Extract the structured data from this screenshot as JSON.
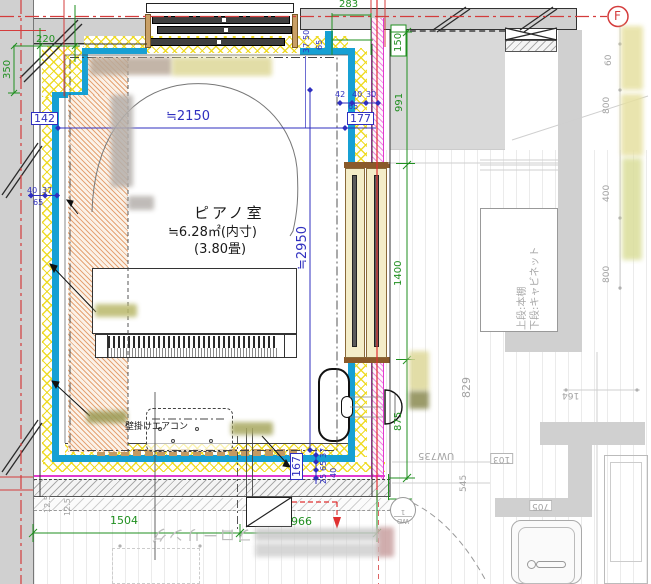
{
  "room": {
    "name": "ピアノ室",
    "area": "≒6.28㎡(内寸)",
    "tatami": "(3.80畳)"
  },
  "equipment": {
    "air_conditioner": "壁掛けエアコン",
    "shelf_upper": "上段:本棚",
    "shelf_lower": "下段:キャビネット",
    "flooring": "フローリング"
  },
  "grid": {
    "f": "F"
  },
  "door_tag": {
    "code": "WD",
    "number": "1"
  },
  "dims": {
    "blue": {
      "w2150": "≒2150",
      "h2950": "≒2950",
      "n142": "142",
      "n177": "177",
      "n167": "167",
      "n42": "42",
      "n40": "40",
      "n30": "30",
      "n65": "65",
      "n37": "37",
      "n50": "50",
      "n25": "25"
    },
    "green": {
      "n220": "220",
      "n350": "350",
      "n283": "283",
      "n150": "150",
      "n991": "991",
      "n1400": "1400",
      "n875": "875",
      "n1504": "1504",
      "n966": "966"
    },
    "gray": {
      "n60": "60",
      "n800": "800",
      "n400": "400",
      "n829": "829",
      "n164": "164",
      "uw735": "UW735",
      "n103": "103",
      "n545": "545",
      "n705": "705",
      "n125": "12.5"
    }
  },
  "colors": {
    "insulation_hatch": "#eeda1e",
    "wall_finish_cyan": "#16a0d4",
    "neighbor_wall_magenta": "#e23ad0",
    "centerline_red": "#d43c3c",
    "dim_blue": "#2f2fbf",
    "dim_green": "#1f8f1f",
    "piano_zone_orange": "#de8a50"
  }
}
